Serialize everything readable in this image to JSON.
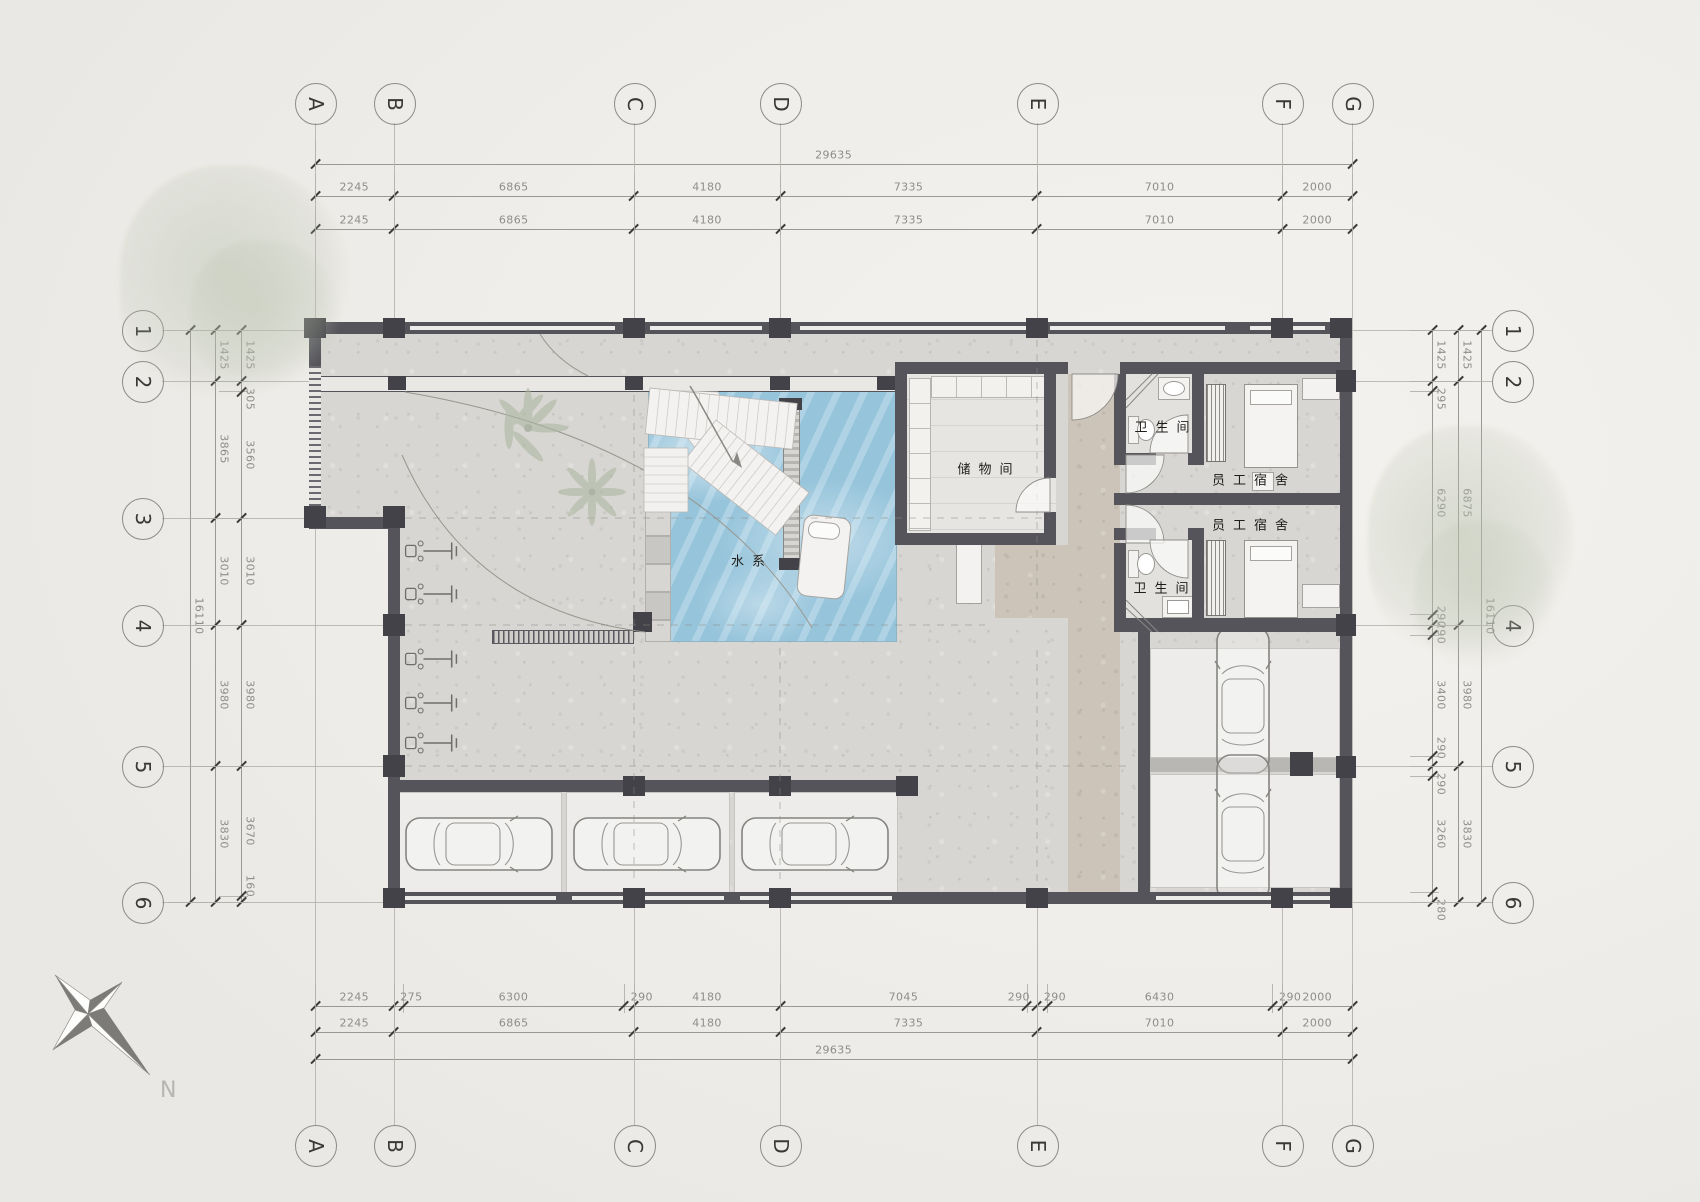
{
  "drawing": {
    "type": "architectural-floor-plan",
    "scale_px_per_mm_x": 0.035,
    "scale_px_per_mm_y": 0.0355
  },
  "grid": {
    "columns": [
      "A",
      "B",
      "C",
      "D",
      "E",
      "F",
      "G"
    ],
    "rows_left": [
      "1",
      "2",
      "3",
      "4",
      "5",
      "6"
    ],
    "rows_right": [
      "1",
      "2",
      "4",
      "5",
      "6"
    ]
  },
  "dimensions": {
    "top": {
      "total": "29635",
      "chain_upper": [
        "2245",
        "6865",
        "4180",
        "7335",
        "7010",
        "2000"
      ],
      "chain_lower": [
        "2245",
        "6865",
        "4180",
        "7335",
        "7010",
        "2000"
      ]
    },
    "bottom": {
      "total": "29635",
      "chain_outer": [
        "2245",
        "6865",
        "4180",
        "7335",
        "7010",
        "2000"
      ],
      "chain_inner": [
        "2245",
        "275",
        "6300",
        "290",
        "4180",
        "7045",
        "290",
        "290",
        "6430",
        "290",
        "2000"
      ]
    },
    "left": {
      "total": "16110",
      "chain_outer": [
        "1425",
        "3865",
        "3010",
        "3980",
        "3830"
      ],
      "chain_inner": [
        "1425",
        "305",
        "3560",
        "3010",
        "3980",
        "3670",
        "160"
      ]
    },
    "right": {
      "total": "16110",
      "chain_outer": [
        "1425",
        "6875",
        "3980",
        "3830"
      ],
      "chain_inner": [
        "1425",
        "295",
        "6290",
        "290",
        "290",
        "3400",
        "290",
        "290",
        "3260",
        "280"
      ]
    }
  },
  "rooms": {
    "pool": "水系",
    "storage": "储物间",
    "bathroom_top": "卫生间",
    "bathroom_bottom": "卫生间",
    "dorm_top": "员工宿舍",
    "dorm_bottom": "员工宿舍"
  },
  "compass": {
    "north_label": "N"
  },
  "colors": {
    "wall": "#55545b",
    "pool_water": "#a0cbe0",
    "concrete": "#d8d6d2",
    "travertine": "#ccc4b8",
    "paper": "#f1efeb",
    "dim_text": "#8f8d89",
    "foliage": "#b8c2ae"
  }
}
